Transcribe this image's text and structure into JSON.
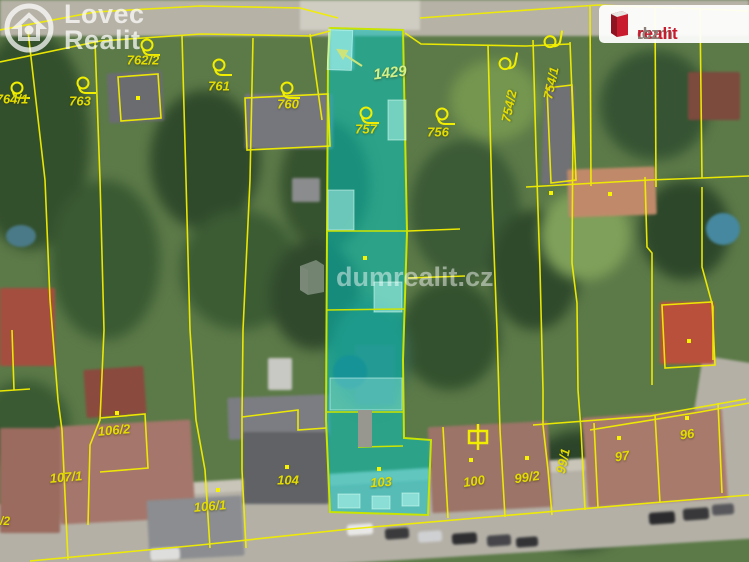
{
  "brand": {
    "lovec_realit": {
      "line1": "Lovec",
      "line2": "Realit"
    },
    "dumrealit_badge": {
      "prefix": "dum",
      "accent": "realit",
      "tld": ".cz"
    },
    "center_watermark": "dumrealit.cz"
  },
  "map": {
    "highlight": {
      "selected_parcel_numbers": [
        "1429",
        "757",
        "103"
      ],
      "fill_color": "#00c8c4",
      "outline_color": "#c8e400"
    },
    "line_color": "#f2ee00",
    "label_color": "#e4dc00",
    "parcel_labels": [
      {
        "t": "764/1",
        "x": 12,
        "y": 99,
        "r": 0
      },
      {
        "t": "763",
        "x": 80,
        "y": 101,
        "r": 0
      },
      {
        "t": "762/2",
        "x": 143,
        "y": 60,
        "r": 0
      },
      {
        "t": "761",
        "x": 219,
        "y": 86,
        "r": 0
      },
      {
        "t": "760",
        "x": 288,
        "y": 104,
        "r": 0
      },
      {
        "t": "1429",
        "x": 390,
        "y": 73,
        "r": -7,
        "s": 15,
        "c": "#d4ef86"
      },
      {
        "t": "757",
        "x": 366,
        "y": 129,
        "r": 0
      },
      {
        "t": "756",
        "x": 438,
        "y": 132,
        "r": 0
      },
      {
        "t": "754/2",
        "x": 509,
        "y": 106,
        "r": -78
      },
      {
        "t": "754/1",
        "x": 551,
        "y": 83,
        "r": -78
      },
      {
        "t": "106/2",
        "x": 114,
        "y": 430,
        "r": -5
      },
      {
        "t": "107/1",
        "x": 66,
        "y": 477,
        "r": -5
      },
      {
        "t": "/2",
        "x": 5,
        "y": 521,
        "r": 0,
        "s": 12
      },
      {
        "t": "106/1",
        "x": 210,
        "y": 506,
        "r": -5
      },
      {
        "t": "104",
        "x": 288,
        "y": 480,
        "r": 0
      },
      {
        "t": "103",
        "x": 381,
        "y": 482,
        "r": -4
      },
      {
        "t": "100",
        "x": 474,
        "y": 481,
        "r": -8
      },
      {
        "t": "99/2",
        "x": 527,
        "y": 477,
        "r": -8
      },
      {
        "t": "99/1",
        "x": 563,
        "y": 461,
        "r": -78
      },
      {
        "t": "97",
        "x": 622,
        "y": 456,
        "r": -8
      },
      {
        "t": "96",
        "x": 687,
        "y": 434,
        "r": -8
      }
    ],
    "boundary_symbols": [
      {
        "x": 17,
        "y": 90,
        "r": 0
      },
      {
        "x": 83,
        "y": 85,
        "r": 0
      },
      {
        "x": 147,
        "y": 47,
        "r": 0
      },
      {
        "x": 219,
        "y": 67,
        "r": 0
      },
      {
        "x": 287,
        "y": 90,
        "r": 0
      },
      {
        "x": 366,
        "y": 115,
        "r": 0
      },
      {
        "x": 442,
        "y": 116,
        "r": 0
      },
      {
        "x": 507,
        "y": 64,
        "r": -80
      },
      {
        "x": 552,
        "y": 42,
        "r": -80
      }
    ],
    "gate_symbol": {
      "x": 478,
      "y": 437
    },
    "parcel_dots": [
      [
        138,
        98
      ],
      [
        117,
        413
      ],
      [
        287,
        467
      ],
      [
        218,
        490
      ],
      [
        365,
        258
      ],
      [
        379,
        469
      ],
      [
        471,
        460
      ],
      [
        527,
        458
      ],
      [
        619,
        438
      ],
      [
        687,
        418
      ],
      [
        551,
        193
      ],
      [
        610,
        194
      ],
      [
        689,
        341
      ]
    ],
    "annotation_arrow": {
      "from_x": 362,
      "to_x": 338,
      "from_y": 66,
      "to_y": 50
    }
  }
}
